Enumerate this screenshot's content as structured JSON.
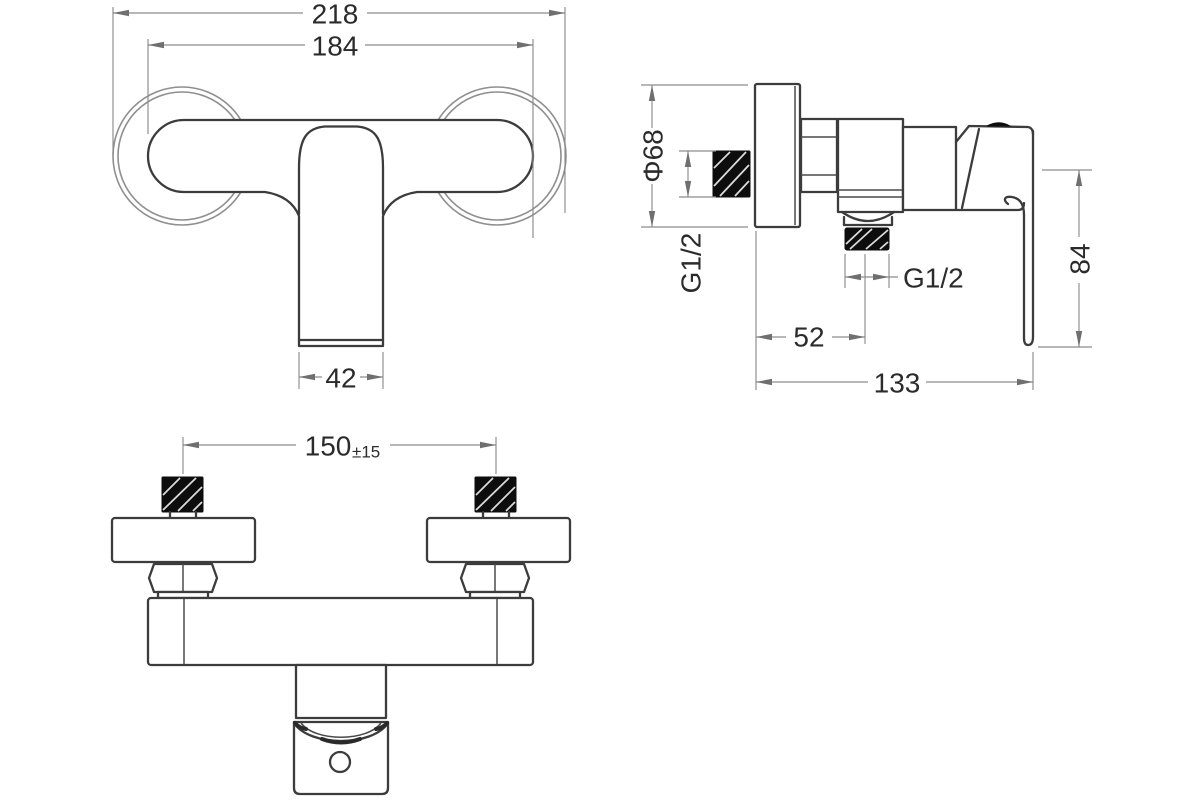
{
  "document": {
    "type": "technical-drawing",
    "subject": "wall-mounted shower mixer faucet, three orthographic views",
    "background_color": "#ffffff",
    "outline_color": "#3c3c3c",
    "dimension_line_color": "#8c8c8c",
    "text_color": "#2b2b2b",
    "thread_fill_color": "#0d0d0d"
  },
  "views": {
    "front": {
      "label": "front-view",
      "dims": {
        "overall_width": "218",
        "body_width": "184",
        "handle_width": "42"
      }
    },
    "side": {
      "label": "side-view",
      "dims": {
        "escutcheon_diameter": "Φ68",
        "inlet_thread": "G1/2",
        "outlet_thread": "G1/2",
        "wall_to_outlet": "52",
        "total_depth": "133",
        "handle_length": "84"
      }
    },
    "bottom": {
      "label": "bottom-view",
      "dims": {
        "inlet_spacing": "150",
        "inlet_spacing_tolerance": "±15"
      }
    }
  }
}
